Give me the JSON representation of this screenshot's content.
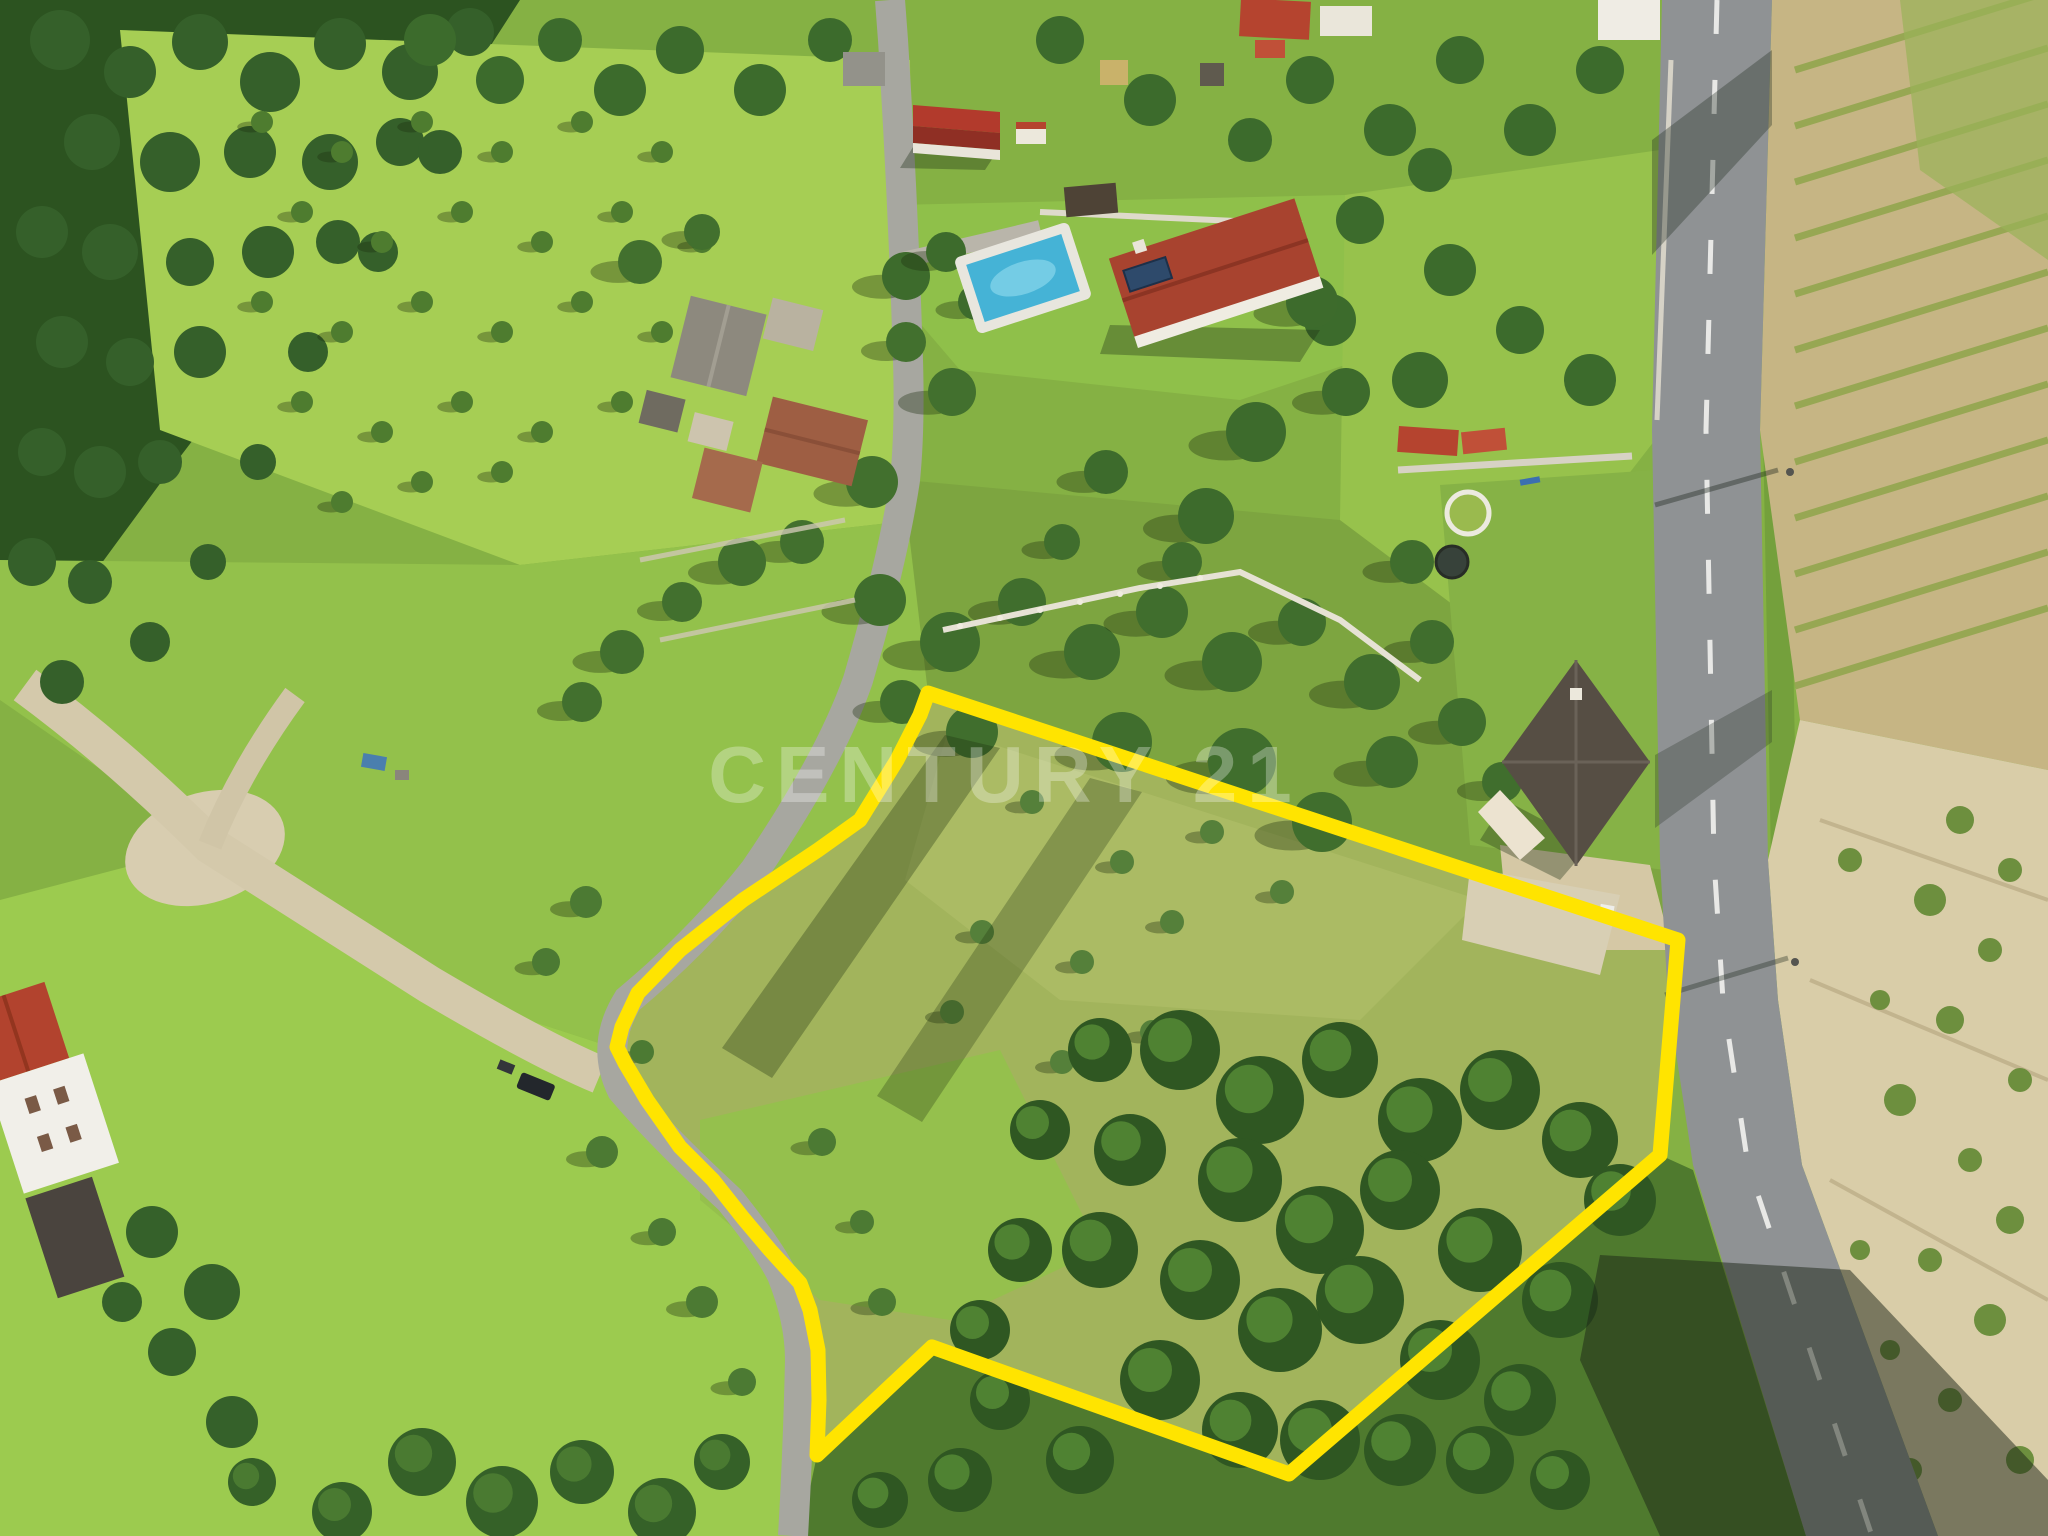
{
  "image": {
    "kind": "aerial-drone-photo",
    "description": "Aerial view of a rural land plot for sale, outlined in yellow, beside a country road",
    "watermark": {
      "text": "CENTURY 21",
      "color": "#ffffff",
      "opacity": 0.3,
      "x": 1005,
      "y": 802,
      "size": 80
    },
    "boundary": {
      "color": "#ffe400",
      "stroke_width": 15,
      "points": "928,693 1678,940 1660,1155 1289,1474 932,1347 817,1455 819,1400 818,1350 810,1310 800,1283 770,1250 743,1218 713,1180 680,1147 647,1100 625,1063 617,1047 622,1027 638,993 680,950 743,900 818,850 860,820 897,760 920,715"
    },
    "vineyard": {
      "rows": 12,
      "x1": 1795,
      "y_start": 70,
      "step": 56,
      "x2": 2048,
      "dy": -78,
      "color": "#8fa54b",
      "width": 7
    },
    "tree_groups": [
      {
        "target": "g-forest",
        "fill": "#35602a",
        "r": 24,
        "items": [
          [
            60,
            40,
            30
          ],
          [
            130,
            72,
            26
          ],
          [
            200,
            42,
            28
          ],
          [
            270,
            82,
            30
          ],
          [
            340,
            44,
            26
          ],
          [
            410,
            72,
            28
          ],
          [
            470,
            32,
            24
          ],
          [
            92,
            142,
            28
          ],
          [
            170,
            162,
            30
          ],
          [
            250,
            152,
            26
          ],
          [
            330,
            162,
            28
          ],
          [
            400,
            142,
            24
          ],
          [
            42,
            232,
            26
          ],
          [
            110,
            252,
            28
          ],
          [
            190,
            262,
            24
          ],
          [
            268,
            252,
            26
          ],
          [
            338,
            242,
            22
          ],
          [
            62,
            342,
            26
          ],
          [
            130,
            362,
            24
          ],
          [
            200,
            352,
            26
          ],
          [
            42,
            452,
            24
          ],
          [
            100,
            472,
            26
          ],
          [
            160,
            462,
            22
          ],
          [
            32,
            562,
            24
          ],
          [
            90,
            582,
            22
          ],
          [
            150,
            642,
            20
          ],
          [
            62,
            682,
            22
          ],
          [
            208,
            562,
            18
          ],
          [
            258,
            462,
            18
          ],
          [
            308,
            352,
            20
          ],
          [
            378,
            252,
            20
          ],
          [
            440,
            152,
            22
          ]
        ]
      },
      {
        "target": "g-top-trees",
        "fill": "#3c6b2c",
        "r": 24,
        "items": [
          [
            430,
            40,
            26
          ],
          [
            500,
            80,
            24
          ],
          [
            560,
            40,
            22
          ],
          [
            620,
            90,
            26
          ],
          [
            680,
            50,
            24
          ],
          [
            760,
            90,
            26
          ],
          [
            830,
            40,
            22
          ],
          [
            1060,
            40,
            24
          ],
          [
            1150,
            100,
            26
          ],
          [
            1250,
            140,
            22
          ],
          [
            1310,
            80,
            24
          ],
          [
            1390,
            130,
            26
          ],
          [
            1460,
            60,
            24
          ],
          [
            1530,
            130,
            26
          ],
          [
            1600,
            70,
            24
          ],
          [
            1240,
            250,
            28
          ],
          [
            1330,
            320,
            26
          ],
          [
            1420,
            380,
            28
          ],
          [
            1360,
            220,
            24
          ],
          [
            1450,
            270,
            26
          ],
          [
            1520,
            330,
            24
          ],
          [
            1590,
            380,
            26
          ],
          [
            1430,
            170,
            22
          ]
        ]
      },
      {
        "target": "g-orchard",
        "fill": "#4e7c2f",
        "r": 11,
        "shadow": true,
        "items": [
          [
            262,
            122
          ],
          [
            342,
            152
          ],
          [
            422,
            122
          ],
          [
            502,
            152
          ],
          [
            582,
            122
          ],
          [
            662,
            152
          ],
          [
            302,
            212
          ],
          [
            382,
            242
          ],
          [
            462,
            212
          ],
          [
            542,
            242
          ],
          [
            622,
            212
          ],
          [
            702,
            242
          ],
          [
            262,
            302
          ],
          [
            342,
            332
          ],
          [
            422,
            302
          ],
          [
            502,
            332
          ],
          [
            582,
            302
          ],
          [
            662,
            332
          ],
          [
            302,
            402
          ],
          [
            382,
            432
          ],
          [
            462,
            402
          ],
          [
            542,
            432
          ],
          [
            622,
            402
          ],
          [
            422,
            482
          ],
          [
            502,
            472
          ],
          [
            342,
            502
          ]
        ]
      },
      {
        "target": "g-village-trees",
        "fill": "#42702e",
        "r": 20,
        "shadow": true,
        "items": [
          [
            640,
            262,
            22
          ],
          [
            702,
            232,
            18
          ],
          [
            906,
            342,
            20
          ],
          [
            952,
            392,
            24
          ],
          [
            872,
            482,
            26
          ],
          [
            802,
            542,
            22
          ],
          [
            742,
            562,
            24
          ],
          [
            682,
            602,
            20
          ],
          [
            622,
            652,
            22
          ],
          [
            582,
            702,
            20
          ]
        ]
      },
      {
        "target": "g-garden-trees",
        "fill": "#3d6b2c",
        "r": 22,
        "shadow": true,
        "items": [
          [
            906,
            276,
            24
          ],
          [
            946,
            252,
            20
          ],
          [
            1256,
            432,
            30
          ],
          [
            1312,
            302,
            26
          ],
          [
            1206,
            516,
            28
          ],
          [
            1106,
            472,
            22
          ],
          [
            1346,
            392,
            24
          ],
          [
            976,
            302,
            18
          ]
        ]
      },
      {
        "target": "g-north-trees",
        "fill": "#406e2d",
        "r": 24,
        "shadow": true,
        "items": [
          [
            880,
            600,
            26
          ],
          [
            950,
            642,
            30
          ],
          [
            1022,
            602,
            24
          ],
          [
            1092,
            652,
            28
          ],
          [
            1162,
            612,
            26
          ],
          [
            1232,
            662,
            30
          ],
          [
            1302,
            622,
            24
          ],
          [
            1372,
            682,
            28
          ],
          [
            1432,
            642,
            22
          ],
          [
            1242,
            762,
            34
          ],
          [
            1322,
            822,
            30
          ],
          [
            1392,
            762,
            26
          ],
          [
            1462,
            722,
            24
          ],
          [
            902,
            702,
            22
          ],
          [
            972,
            732,
            26
          ],
          [
            1122,
            742,
            30
          ],
          [
            1502,
            782,
            20
          ],
          [
            1182,
            562,
            20
          ],
          [
            1062,
            542,
            18
          ],
          [
            1412,
            562,
            22
          ]
        ]
      },
      {
        "target": "g-lane-trees",
        "fill": "#4c7a33",
        "r": 14,
        "shadow": true,
        "items": [
          [
            586,
            902,
            16
          ],
          [
            546,
            962,
            14
          ],
          [
            602,
            1152,
            16
          ],
          [
            662,
            1232,
            14
          ],
          [
            702,
            1302,
            16
          ],
          [
            742,
            1382,
            14
          ],
          [
            642,
            1052,
            12
          ],
          [
            822,
            1142,
            14
          ],
          [
            862,
            1222,
            12
          ],
          [
            882,
            1302,
            14
          ]
        ]
      },
      {
        "target": "g-plot-olives",
        "fill": "#55803a",
        "r": 12,
        "shadow": true,
        "items": [
          [
            1032,
            802
          ],
          [
            1122,
            862
          ],
          [
            1212,
            832
          ],
          [
            982,
            932
          ],
          [
            1082,
            962
          ],
          [
            1172,
            922
          ],
          [
            1282,
            892
          ],
          [
            1062,
            1062
          ],
          [
            952,
            1012
          ],
          [
            1152,
            1032
          ]
        ]
      },
      {
        "target": "g-woodland",
        "fill": "#2f5722",
        "r": 36,
        "highlight": "#4f8232",
        "items": [
          [
            1180,
            1050,
            40
          ],
          [
            1260,
            1100,
            44
          ],
          [
            1340,
            1060,
            38
          ],
          [
            1420,
            1120,
            42
          ],
          [
            1500,
            1090,
            40
          ],
          [
            1580,
            1140,
            38
          ],
          [
            1620,
            1200,
            36
          ],
          [
            1240,
            1180,
            42
          ],
          [
            1320,
            1230,
            44
          ],
          [
            1400,
            1190,
            40
          ],
          [
            1480,
            1250,
            42
          ],
          [
            1560,
            1300,
            38
          ],
          [
            1200,
            1280,
            40
          ],
          [
            1280,
            1330,
            42
          ],
          [
            1360,
            1300,
            44
          ],
          [
            1440,
            1360,
            40
          ],
          [
            1520,
            1400,
            36
          ],
          [
            1130,
            1150,
            36
          ],
          [
            1100,
            1250,
            38
          ],
          [
            1160,
            1380,
            40
          ],
          [
            1240,
            1430,
            38
          ],
          [
            1320,
            1440,
            40
          ],
          [
            1400,
            1450,
            36
          ],
          [
            1080,
            1460,
            34
          ],
          [
            1000,
            1400,
            30
          ],
          [
            960,
            1480,
            32
          ],
          [
            880,
            1500,
            28
          ],
          [
            1480,
            1460,
            34
          ],
          [
            1560,
            1480,
            30
          ],
          [
            1100,
            1050,
            32
          ],
          [
            1040,
            1130,
            30
          ],
          [
            1020,
            1250,
            32
          ],
          [
            980,
            1330,
            30
          ]
        ]
      },
      {
        "target": "g-bottom-trees",
        "fill": "#356128",
        "r": 30,
        "highlight": "#4a7a31",
        "items": [
          [
            422,
            1462,
            34
          ],
          [
            502,
            1502,
            36
          ],
          [
            582,
            1472,
            32
          ],
          [
            662,
            1512,
            34
          ],
          [
            342,
            1512,
            30
          ],
          [
            722,
            1462,
            28
          ],
          [
            252,
            1482,
            24
          ]
        ]
      },
      {
        "target": "g-hedge-trees",
        "fill": "#35612a",
        "r": 24,
        "items": [
          [
            152,
            1232,
            26
          ],
          [
            212,
            1292,
            28
          ],
          [
            172,
            1352,
            24
          ],
          [
            232,
            1422,
            26
          ],
          [
            122,
            1302,
            20
          ]
        ]
      },
      {
        "target": "g-scrub",
        "fill": "#6d8f3e",
        "r": 12,
        "items": [
          [
            1960,
            820,
            14
          ],
          [
            2010,
            870,
            12
          ],
          [
            1930,
            900,
            16
          ],
          [
            1990,
            950,
            12
          ],
          [
            1950,
            1020,
            14
          ],
          [
            2020,
            1080,
            12
          ],
          [
            1900,
            1100,
            16
          ],
          [
            1970,
            1160,
            12
          ],
          [
            2010,
            1220,
            14
          ],
          [
            1930,
            1260,
            12
          ],
          [
            1990,
            1320,
            16
          ],
          [
            1950,
            1400,
            12
          ],
          [
            2020,
            1460,
            14
          ],
          [
            1890,
            1350,
            10
          ],
          [
            1910,
            1470,
            12
          ],
          [
            1860,
            1250,
            10
          ],
          [
            1880,
            1000,
            10
          ],
          [
            1850,
            860,
            12
          ]
        ]
      }
    ]
  }
}
